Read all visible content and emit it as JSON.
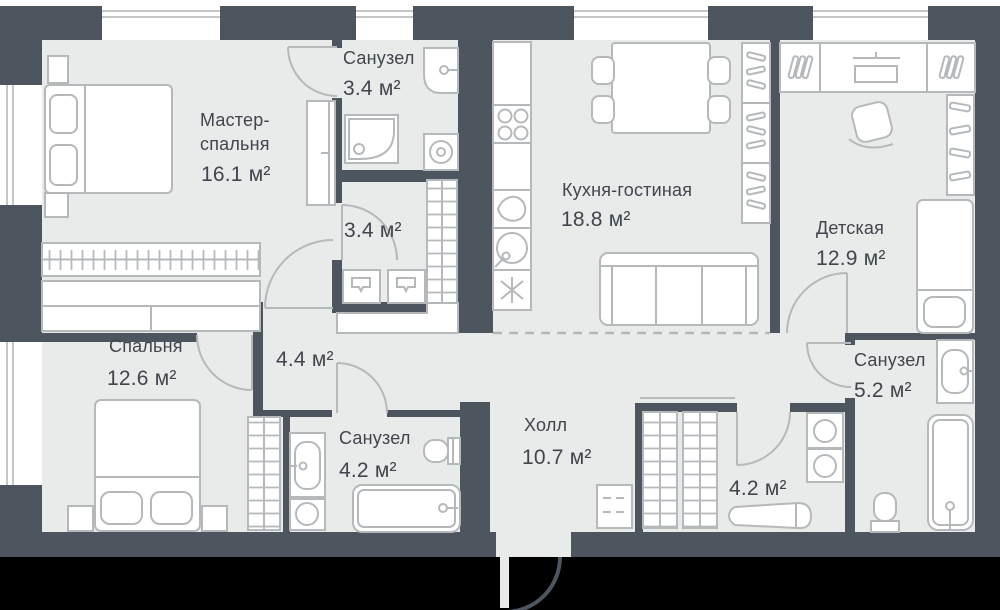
{
  "colors": {
    "wall": "#4d555e",
    "floor": "#e9eaea",
    "furniture_outline": "#b6b9bc",
    "text": "#3f464d",
    "outside": "#ffffff",
    "bottom_band": "#000000"
  },
  "rooms": {
    "master_bedroom": {
      "name_line1": "Мастер-",
      "name_line2": "спальня",
      "area": "16.1 м²"
    },
    "bathroom_master": {
      "name": "Санузел",
      "area": "3.4 м²"
    },
    "wardrobe": {
      "area": "3.4 м²"
    },
    "kitchen_living": {
      "name": "Кухня-гостиная",
      "area": "18.8 м²"
    },
    "kids_room": {
      "name": "Детская",
      "area": "12.9 м²"
    },
    "bedroom": {
      "name": "Спальня",
      "area": "12.6 м²"
    },
    "corridor": {
      "area": "4.4 м²"
    },
    "bathroom_kids": {
      "name": "Санузел",
      "area": "5.2 м²"
    },
    "bathroom_bedroom": {
      "name": "Санузел",
      "area": "4.2 м²"
    },
    "hall": {
      "name": "Холл",
      "area": "10.7 м²"
    },
    "storage": {
      "area": "4.2 м²"
    }
  }
}
